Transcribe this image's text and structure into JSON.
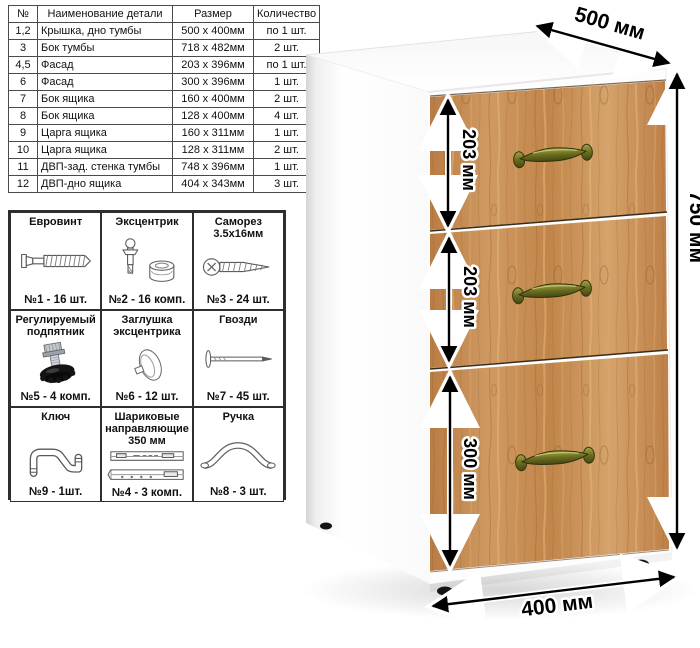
{
  "parts_table": {
    "headers": [
      "№",
      "Наименование детали",
      "Размер",
      "Количество"
    ],
    "rows": [
      [
        "1,2",
        "Крышка, дно тумбы",
        "500 x 400мм",
        "по 1 шт."
      ],
      [
        "3",
        "Бок тумбы",
        "718 x 482мм",
        "2 шт."
      ],
      [
        "4,5",
        "Фасад",
        "203 x 396мм",
        "по 1 шт."
      ],
      [
        "6",
        "Фасад",
        "300 x 396мм",
        "1 шт."
      ],
      [
        "7",
        "Бок ящика",
        "160 x 400мм",
        "2 шт."
      ],
      [
        "8",
        "Бок ящика",
        "128 x 400мм",
        "4 шт."
      ],
      [
        "9",
        "Царга ящика",
        "160 x 311мм",
        "1 шт."
      ],
      [
        "10",
        "Царга ящика",
        "128 x 311мм",
        "2 шт."
      ],
      [
        "11",
        "ДВП-зад. стенка тумбы",
        "748 x 396мм",
        "1 шт."
      ],
      [
        "12",
        "ДВП-дно ящика",
        "404 x 343мм",
        "3 шт."
      ]
    ]
  },
  "hardware": {
    "items": [
      {
        "title": "Евровинт",
        "count": "№1 - 16 шт.",
        "icon": "euro-screw-icon"
      },
      {
        "title": "Эксцентрик",
        "count": "№2 - 16 комп.",
        "icon": "cam-icon"
      },
      {
        "title": "Саморез 3.5х16мм",
        "count": "№3 - 24 шт.",
        "icon": "self-tapping-screw-icon"
      },
      {
        "title": "Регулируемый подпятник",
        "count": "№5 - 4 комп.",
        "icon": "adjustable-foot-icon"
      },
      {
        "title": "Заглушка эксцентрика",
        "count": "№6 - 12 шт.",
        "icon": "cam-cover-icon"
      },
      {
        "title": "Гвозди",
        "count": "№7 - 45 шт.",
        "icon": "nail-icon"
      },
      {
        "title": "Ключ",
        "count": "№9 - 1шт.",
        "icon": "hex-key-icon"
      },
      {
        "title": "Шариковые направляющие 350 мм",
        "count": "№4 - 3 комп.",
        "icon": "ball-slides-icon"
      },
      {
        "title": "Ручка",
        "count": "№8 - 3 шт.",
        "icon": "pull-handle-icon"
      }
    ]
  },
  "cabinet": {
    "dimensions": {
      "depth": "500 мм",
      "height": "750 мм",
      "width": "400 мм",
      "drawer_top": "203 мм",
      "drawer_middle": "203 мм",
      "drawer_bottom": "300 мм"
    },
    "colors": {
      "wood": "#c68d55",
      "wood_dark": "#9c6a38",
      "wood_light": "#e3b67f",
      "handle_brass": "#7c7e2a",
      "carcass": "#ffffff",
      "dimension": "#000000"
    }
  }
}
